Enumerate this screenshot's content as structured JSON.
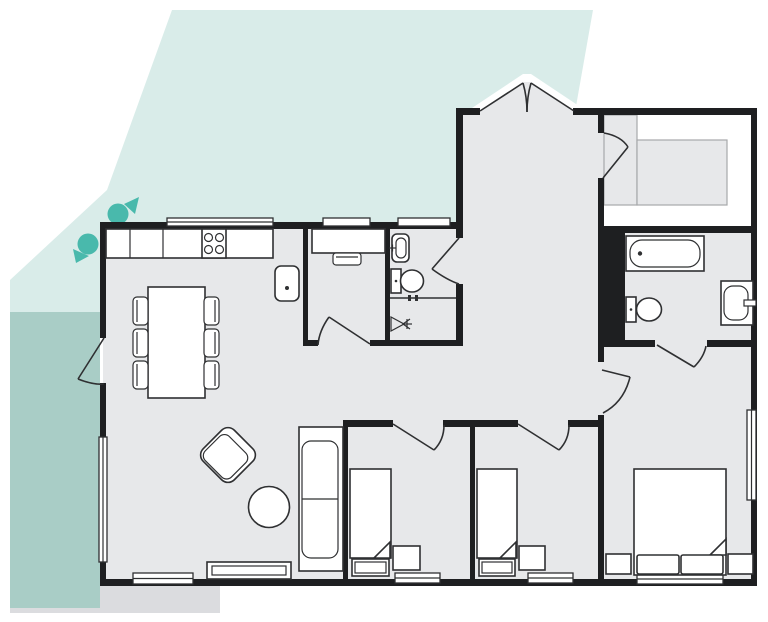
{
  "title": "floor-plan",
  "colors": {
    "lot": "#d9ece9",
    "deck": "#a9cdc6",
    "patio": "#dbdcdf",
    "floor": "#e7e8ea",
    "wall": "#1e1f21",
    "stroke": "#2f3032",
    "tree": "#49b9ac",
    "shelfline": "#a7a8aa"
  },
  "site": {
    "areas": [
      "lot",
      "deck",
      "patio-step"
    ],
    "tree_markers": 2
  },
  "rooms": [
    "kitchen-dining",
    "living-room",
    "study-nook",
    "wc",
    "laundry",
    "entry-hall",
    "walk-in-closet",
    "bathroom",
    "bedroom-1",
    "bedroom-2",
    "master-bedroom"
  ],
  "fixtures": [
    "kitchen-counter",
    "stove-4-burners",
    "kitchen-sink",
    "dining-table",
    "dining-chair-x6",
    "armchair",
    "round-side-table",
    "sofa",
    "tv-stand",
    "desk",
    "desk-chair",
    "wash-basin",
    "toilet",
    "water-tap-valve",
    "bathtub",
    "toilet-2",
    "bathroom-sink",
    "single-bed-x2",
    "double-bed",
    "nightstand-x4",
    "pillow-x2",
    "entry-double-door",
    "window-x8",
    "door-arc-x9",
    "sliding-door",
    "service-shaft"
  ]
}
